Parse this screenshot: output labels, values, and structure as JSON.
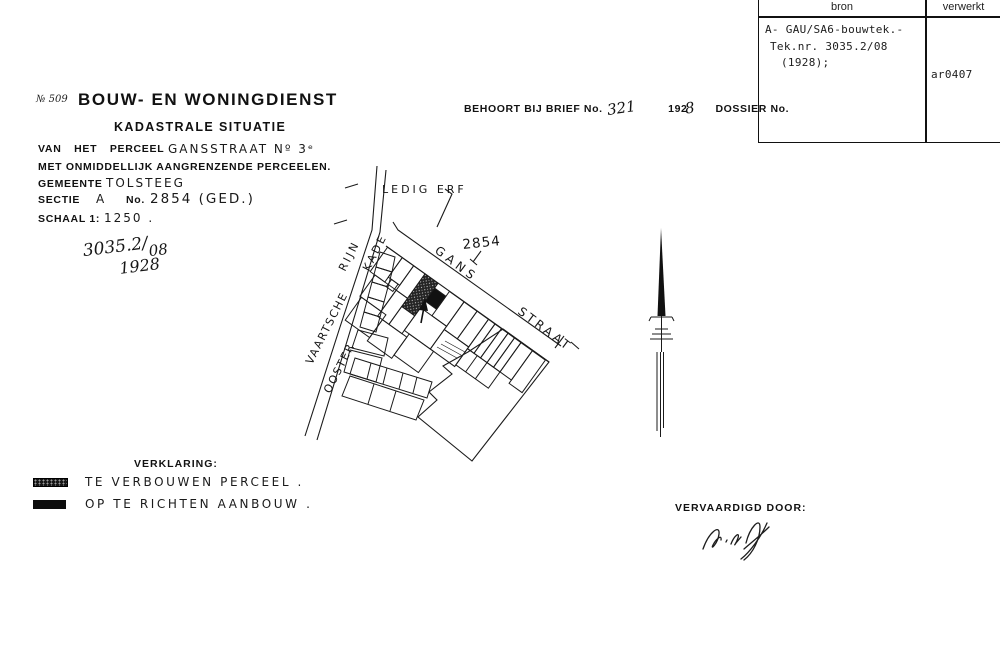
{
  "register_table": {
    "col1_header": "bron",
    "col2_header": "verwerkt",
    "source_line1": "A- GAU/SA6-bouwtek.-",
    "source_line2": "Tek.nr. 3035.2/08",
    "source_line3": "(1928);",
    "processed_code": "ar0407"
  },
  "header": {
    "doc_number": "№ 509",
    "title": "BOUW- EN WONINGDIENST",
    "subtitle": "KADASTRALE SITUATIE"
  },
  "reference_line": {
    "label": "BEHOORT BIJ BRIEF No.",
    "brief_number": "321",
    "year_printed": "192",
    "year_handwritten_digit": "8",
    "dossier_label": "DOSSIER No."
  },
  "details": {
    "perceel_label": "VAN HET PERCEEL",
    "perceel_value": "GANSSTRAAT Nº 3ᵉ",
    "adjacent_line": "MET ONMIDDELLIJK AANGRENZENDE PERCEELEN.",
    "gemeente_label": "GEMEENTE",
    "gemeente_value": "TOLSTEEG",
    "sectie_label": "SECTIE",
    "sectie_value": "A",
    "no_label": "No.",
    "parcel_value": "2854 (GED.)",
    "schaal_label": "SCHAAL 1:",
    "schaal_value": "1250 ."
  },
  "annotation": {
    "drawing_number": "3035.2/",
    "drawing_suffix": "08",
    "year": "1928"
  },
  "map": {
    "labels": {
      "ledig_erf": "LEDIG ERF",
      "vaartsche": "VAARTSCHE",
      "rijn": "RIJN",
      "ooster": "OOSTER",
      "kade": "KADE",
      "gans": "GANS",
      "straat": "STRAAT",
      "parcel_number": "2854"
    }
  },
  "legend": {
    "title": "VERKLARING:",
    "items": [
      {
        "label": "TE VERBOUWEN PERCEEL ."
      },
      {
        "label": "OP TE RICHTEN AANBOUW ."
      }
    ]
  },
  "footer": {
    "made_by_label": "VERVAARDIGD DOOR:"
  }
}
